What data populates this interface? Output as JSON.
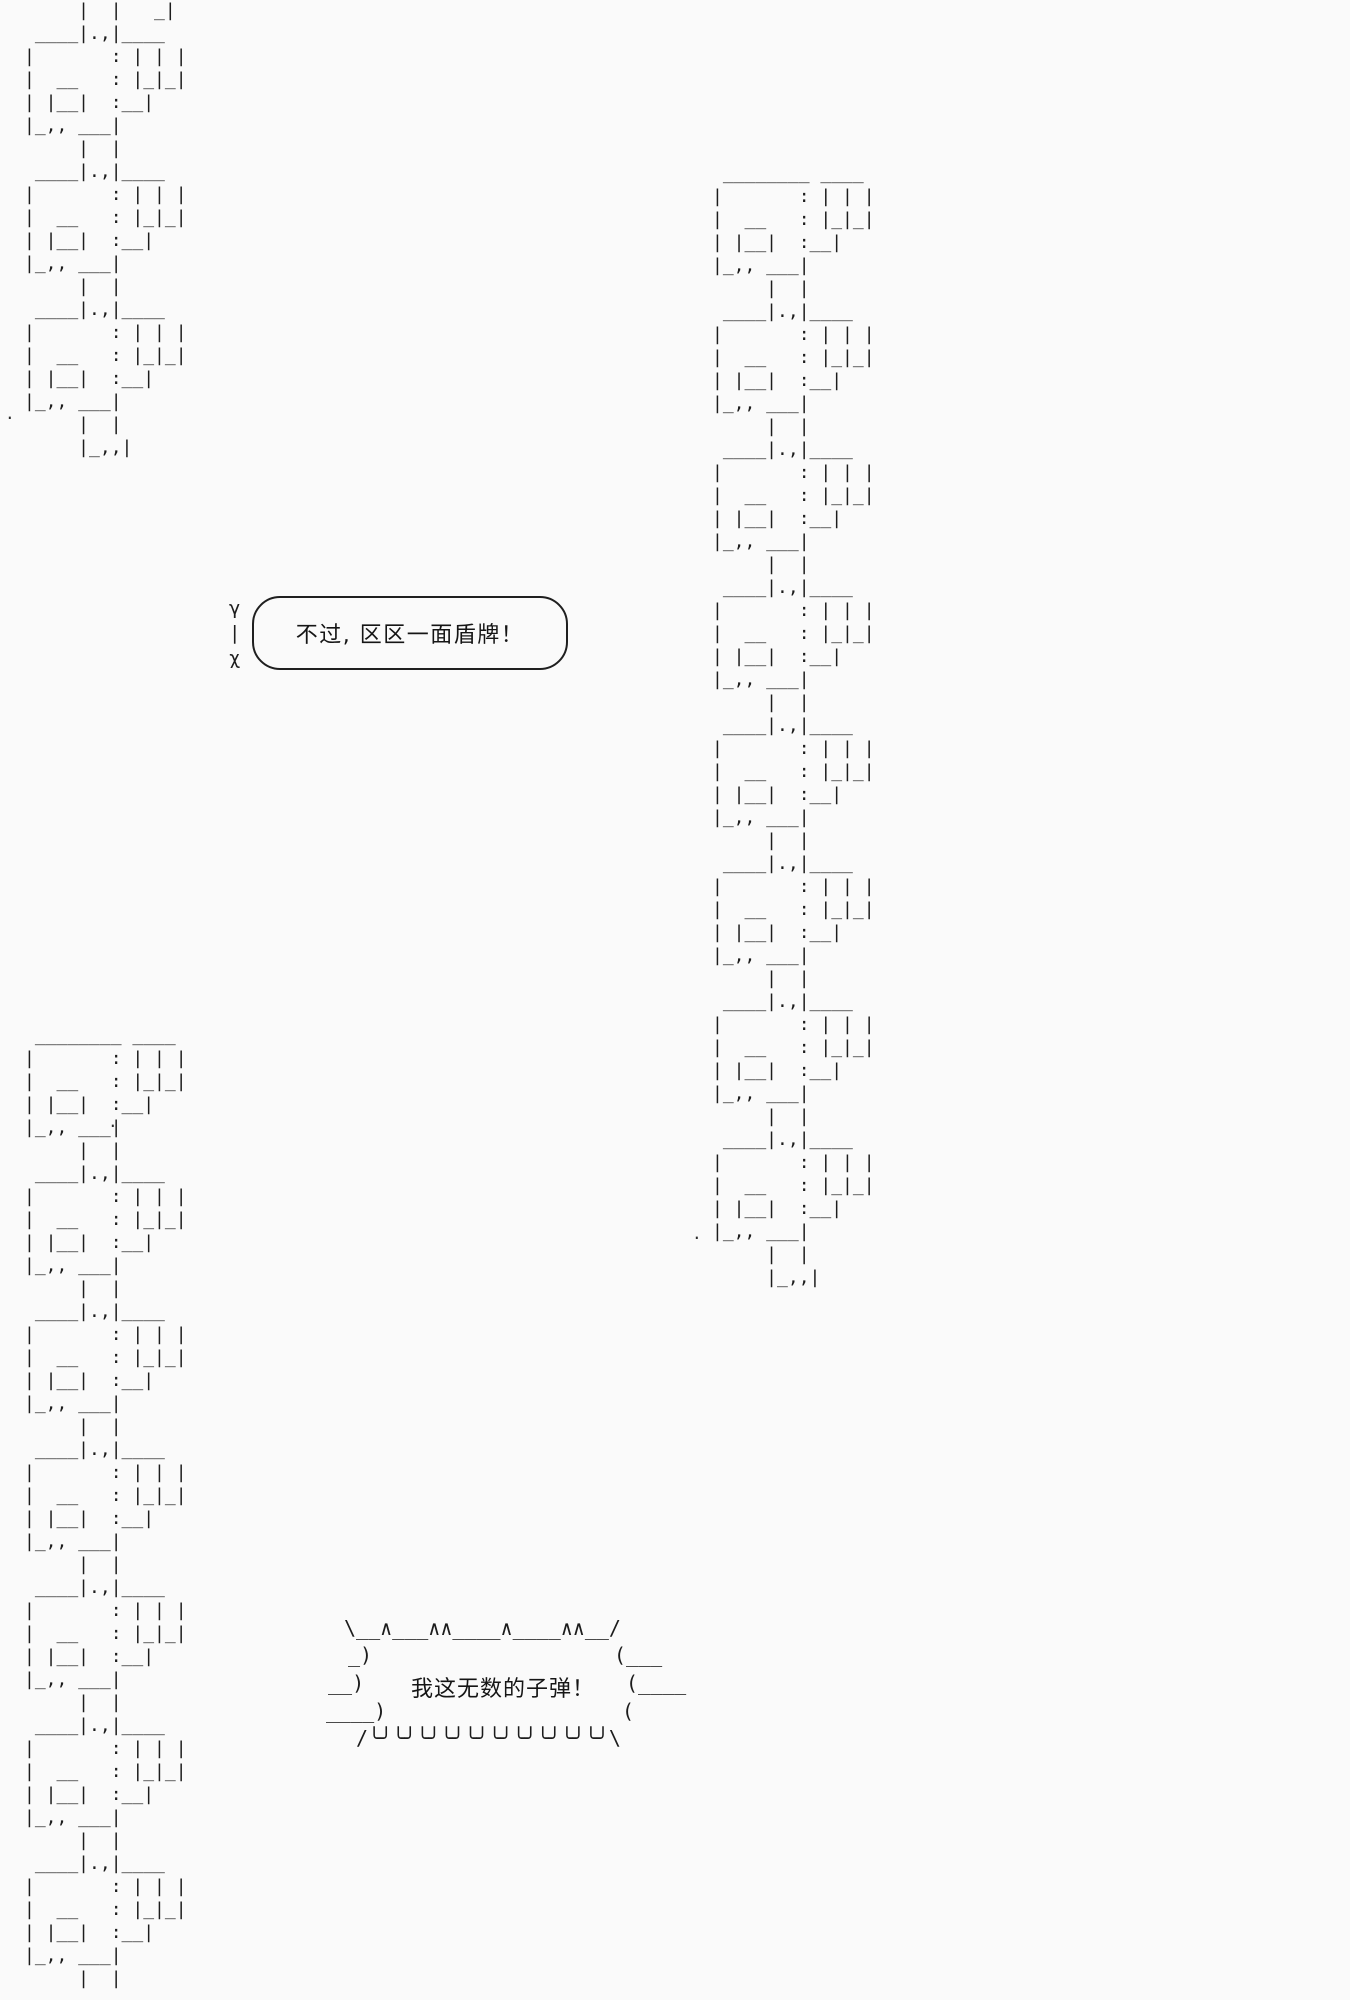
{
  "page": {
    "background": "#fafafa",
    "ink": "#1c1c1c"
  },
  "bubbles": {
    "calm": {
      "tail": "γ\n|\nχ",
      "text": "不过, 区区一面盾牌！"
    },
    "shout": {
      "top": "\\__∧___∧∧____∧____∧∧__/",
      "row2_left": "_)",
      "row2_right": "(___",
      "row3_left": "__)",
      "row3_right": "(____",
      "row4_left": "____)",
      "row4_right": "(",
      "bottom": "/╰╯╰╯╰╯╰╯╰╯╰╯╰╯╰╯╰╯╰╯\\",
      "text": "我这无数的子弹！"
    }
  },
  "chains": {
    "top_left": {
      "head": [
        "     |  |",
        "     |  |   _|"
      ],
      "unit": [
        " ____|.,|____  ",
        "|       : | | |",
        "|  __   : |_|_|",
        "| |__|  :__|",
        "|_,, ___|",
        "     |  |"
      ],
      "repeat": 3,
      "tail": [
        "     |_,,|"
      ]
    },
    "right": {
      "head": [
        " ________ ____ ",
        "|       : | | |",
        "|  __   : |_|_|",
        "| |__|  :__|",
        "|_,, ___|",
        "     |  |"
      ],
      "unit": [
        " ____|.,|____  ",
        "|       : | | |",
        "|  __   : |_|_|",
        "| |__|  :__|",
        "|_,, ___|",
        "     |  |"
      ],
      "repeat": 6,
      "tail": [
        " ____|.,|____  ",
        "|       : | | |",
        "|  __   : |_|_|",
        "| |__|  :__|",
        "|_,, ___|",
        "     |  |",
        "     |_,,|"
      ]
    },
    "bottom_left": {
      "head": [
        " ________ ____ ",
        "|       : | | |",
        "|  __   : |_|_|",
        "| |__|  :__|",
        "|_,, ___|",
        "     |  |"
      ],
      "unit": [
        " ____|.,|____  ",
        "|       : | | |",
        "|  __   : |_|_|",
        "| |__|  :__|",
        "|_,, ___|",
        "     |  |"
      ],
      "repeat": 6,
      "tail": []
    }
  },
  "stray_marks": {
    "m1": ".",
    "m2": ".",
    "m3": "."
  }
}
